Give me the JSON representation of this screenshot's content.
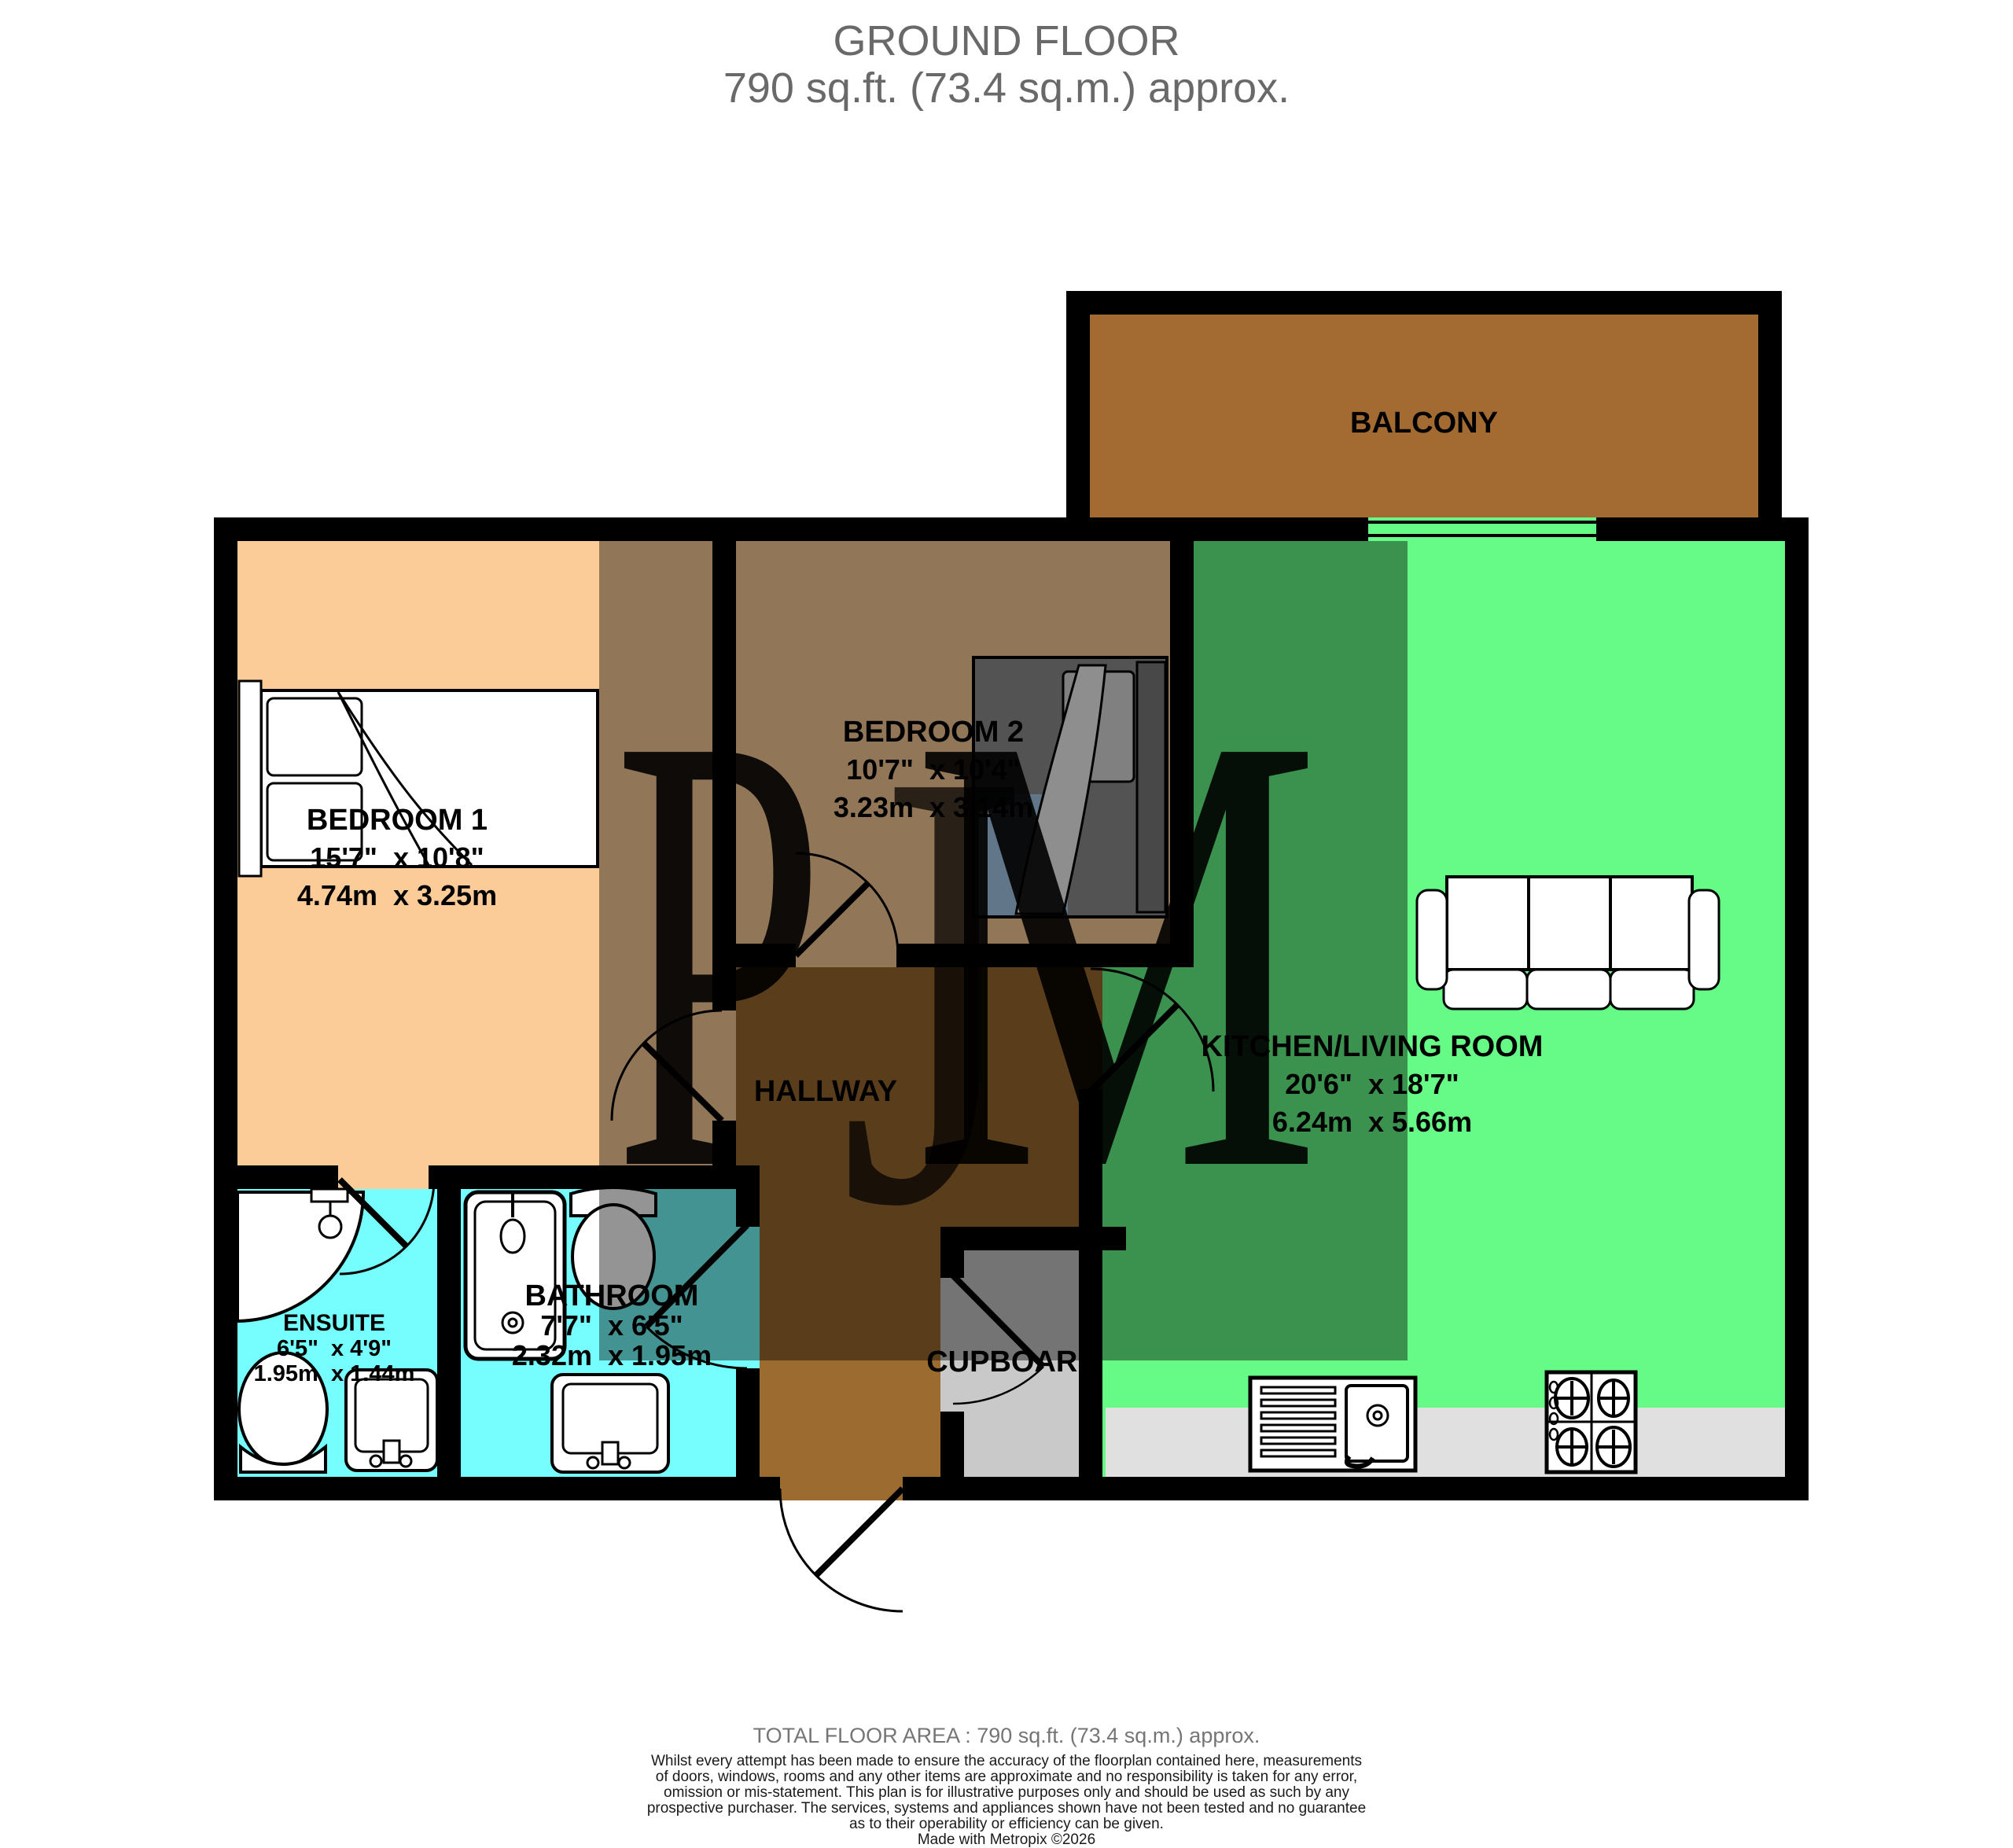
{
  "title": {
    "line1": "GROUND FLOOR",
    "line2": "790 sq.ft. (73.4 sq.m.) approx."
  },
  "watermark": {
    "p": "P",
    "j": "J",
    "m": "M"
  },
  "rooms": {
    "balcony": {
      "name": "BALCONY"
    },
    "bedroom1": {
      "name": "BEDROOM 1",
      "imperial": "15'7\"  x 10'8\"",
      "metric": "4.74m  x 3.25m"
    },
    "bedroom2": {
      "name": "BEDROOM 2",
      "imperial": "10'7\"  x 10'4\"",
      "metric": "3.23m  x 3.14m"
    },
    "kitchen_living": {
      "name": "KITCHEN/LIVING ROOM",
      "imperial": "20'6\"  x 18'7\"",
      "metric": "6.24m  x 5.66m"
    },
    "hallway": {
      "name": "HALLWAY"
    },
    "bathroom": {
      "name": "BATHROOM",
      "imperial": "7'7\"  x 6'5\"",
      "metric": "2.32m  x 1.95m"
    },
    "ensuite": {
      "name": "ENSUITE",
      "imperial": "6'5\"  x 4'9\"",
      "metric": "1.95m  x 1.44m"
    },
    "cupboard": {
      "name": "CUPBOARD"
    }
  },
  "footer": {
    "total": "TOTAL FLOOR AREA : 790 sq.ft. (73.4 sq.m.) approx.",
    "disclaimer_lines": [
      "Whilst every attempt has been made to ensure the accuracy of the floorplan contained here, measurements",
      "of doors, windows, rooms and any other items are approximate and no responsibility is taken for any error,",
      "omission or mis-statement. This plan is for illustrative purposes only and should be used as such by any",
      "prospective purchaser. The services, systems and appliances shown have not been tested and no guarantee",
      "as to their operability or efficiency can be given.",
      "Made with Metropix ©2026"
    ]
  },
  "colors": {
    "wall": "#000000",
    "bedroom_floor": "#FBCB98",
    "kitchen_floor": "#66FB87",
    "bath_floor": "#76FEFE",
    "hallway_floor": "#9C6B2F",
    "balcony_floor": "#A36B31",
    "cupboard_floor": "#C9C9C9",
    "counter": "#E0E0E0",
    "overlay_shadow": "rgba(0,0,0,0.42)",
    "watermark_p": "#F4C794",
    "watermark_j": "#D9B488",
    "watermark_m": "#3BAD88",
    "title_grey": "#696969"
  }
}
